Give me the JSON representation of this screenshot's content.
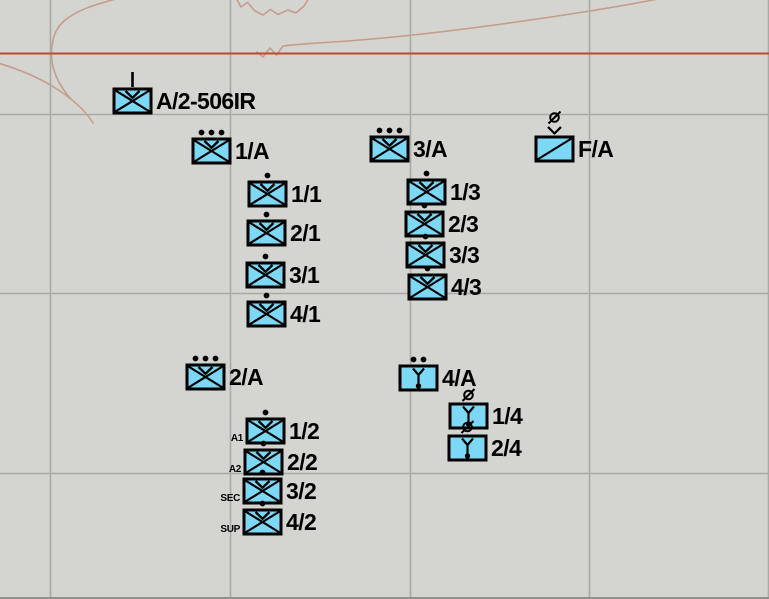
{
  "map": {
    "background_color": "#d4d5d1",
    "grid_color": "#a8aaa6",
    "contour_color": "#c59e8b",
    "bottom_edge_color": "#8f918d",
    "grid_vertical_x": [
      50,
      230,
      410,
      589,
      768
    ],
    "grid_horizontal_y": [
      114,
      293,
      473
    ],
    "boundary_line": {
      "color": "#bb4a33",
      "y": 53.5
    }
  },
  "symbology": {
    "fill_color": "#7cd8f4",
    "frame_color": "#000000"
  },
  "units": [
    {
      "label": "A/2-506IR",
      "echelon": "company",
      "type": "infantry",
      "air_assault": true,
      "x": 113,
      "y": 87
    },
    {
      "label": "1/A",
      "echelon": "platoon",
      "type": "infantry",
      "air_assault": true,
      "x": 192,
      "y": 137
    },
    {
      "label": "3/A",
      "echelon": "platoon",
      "type": "infantry",
      "air_assault": true,
      "x": 370,
      "y": 135
    },
    {
      "label": "F/A",
      "echelon": "team",
      "type": "support",
      "air_assault": true,
      "x": 535,
      "y": 135
    },
    {
      "label": "1/1",
      "echelon": "squad",
      "type": "infantry",
      "air_assault": true,
      "x": 248,
      "y": 180
    },
    {
      "label": "2/1",
      "echelon": "squad",
      "type": "infantry",
      "air_assault": true,
      "x": 247,
      "y": 219
    },
    {
      "label": "3/1",
      "echelon": "squad",
      "type": "infantry",
      "air_assault": true,
      "x": 246,
      "y": 261
    },
    {
      "label": "4/1",
      "echelon": "squad",
      "type": "infantry",
      "air_assault": true,
      "x": 247,
      "y": 300
    },
    {
      "label": "1/3",
      "echelon": "squad",
      "type": "infantry",
      "air_assault": true,
      "x": 407,
      "y": 178
    },
    {
      "label": "2/3",
      "echelon": "squad",
      "type": "infantry",
      "air_assault": true,
      "x": 405,
      "y": 210
    },
    {
      "label": "3/3",
      "echelon": "squad",
      "type": "infantry",
      "air_assault": true,
      "x": 406,
      "y": 241
    },
    {
      "label": "4/3",
      "echelon": "squad",
      "type": "infantry",
      "air_assault": true,
      "x": 408,
      "y": 273
    },
    {
      "label": "2/A",
      "echelon": "platoon",
      "type": "infantry",
      "air_assault": true,
      "x": 186,
      "y": 363
    },
    {
      "label": "1/2",
      "echelon": "squad",
      "type": "infantry",
      "air_assault": true,
      "x": 246,
      "y": 417,
      "side_label": "A1"
    },
    {
      "label": "2/2",
      "echelon": "squad",
      "type": "infantry",
      "air_assault": true,
      "x": 244,
      "y": 448,
      "side_label": "A2"
    },
    {
      "label": "3/2",
      "echelon": "squad",
      "type": "infantry",
      "air_assault": true,
      "x": 243,
      "y": 477,
      "side_label": "SEC"
    },
    {
      "label": "4/2",
      "echelon": "squad",
      "type": "infantry",
      "air_assault": true,
      "x": 243,
      "y": 508,
      "side_label": "SUP"
    },
    {
      "label": "4/A",
      "echelon": "section",
      "type": "mortar",
      "air_assault": false,
      "x": 399,
      "y": 364
    },
    {
      "label": "1/4",
      "echelon": "team",
      "type": "mortar",
      "air_assault": false,
      "x": 449,
      "y": 402
    },
    {
      "label": "2/4",
      "echelon": "team",
      "type": "mortar",
      "air_assault": false,
      "x": 448,
      "y": 434
    }
  ]
}
